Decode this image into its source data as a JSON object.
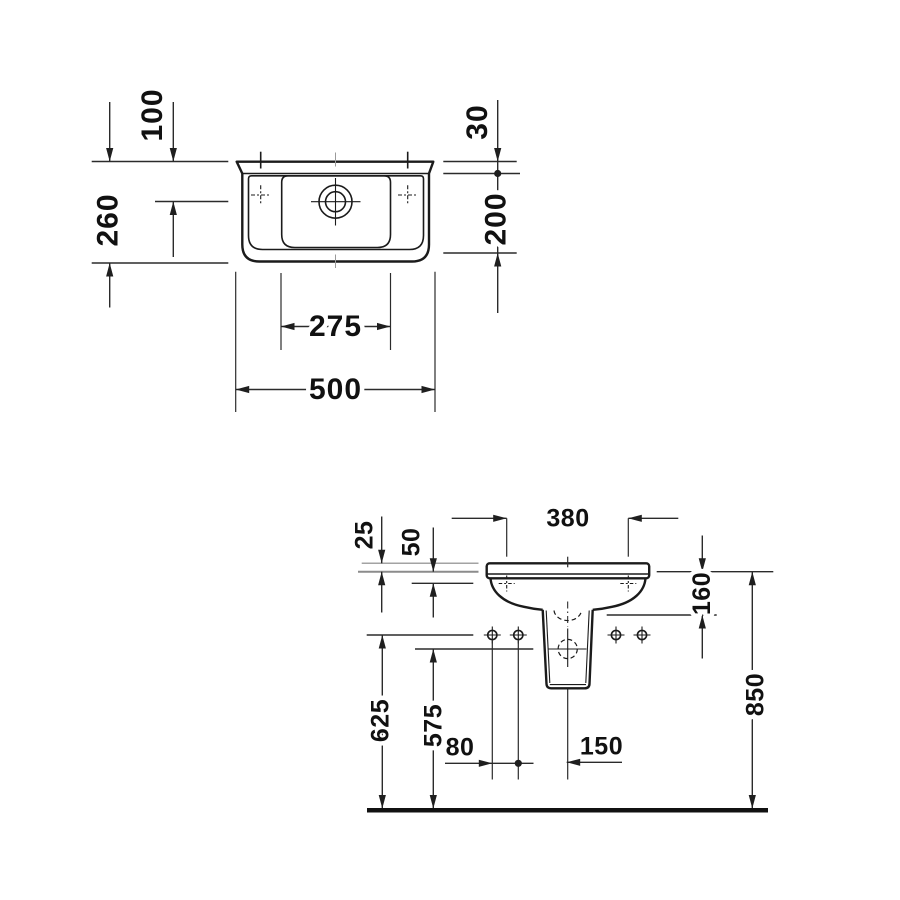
{
  "drawing": {
    "kind": "washbasin-technical-dimension-drawing",
    "unit": "mm",
    "plan": {
      "dims": {
        "d100": "100",
        "d260": "260",
        "d30": "30",
        "d200": "200",
        "d275": "275",
        "d500": "500"
      }
    },
    "front": {
      "dims": {
        "f380": "380",
        "f25": "25",
        "f50": "50",
        "f160": "160",
        "f625": "625",
        "f575": "575",
        "f80": "80",
        "f150": "150",
        "f850": "850"
      }
    }
  }
}
